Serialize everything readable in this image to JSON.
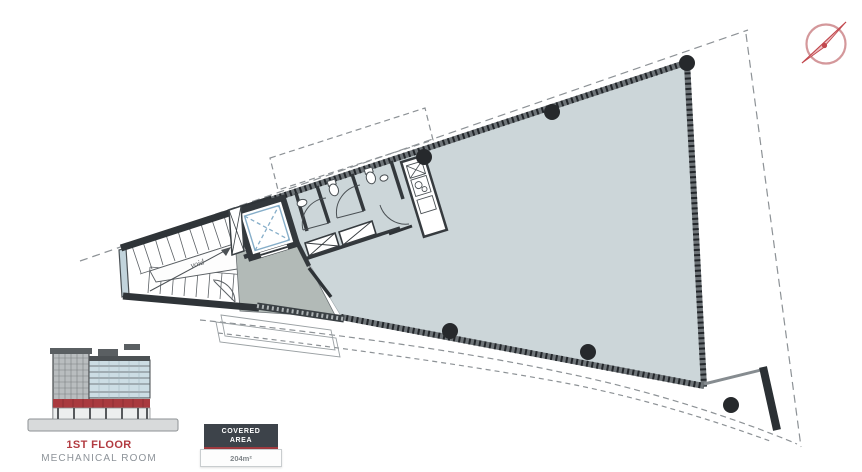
{
  "floor_legend": {
    "title": "1ST FLOOR",
    "subtitle": "MECHANICAL ROOM"
  },
  "covered_area": {
    "label_line1": "COVERED",
    "label_line2": "AREA",
    "value": "204m²"
  },
  "plan": {
    "void_label": "void"
  },
  "colors": {
    "accent_red": "#a93a3f",
    "plan_fill": "#ccd6d9",
    "vestibule_fill": "#b2bab7",
    "wall": "#2f3438",
    "ribbed_wall_base": "#6e7478",
    "dashed_line": "#8d9296",
    "column": "#26292c",
    "elevator_blue": "#86aec9",
    "compass": "#c2484e",
    "text_gray": "#8d9399"
  }
}
